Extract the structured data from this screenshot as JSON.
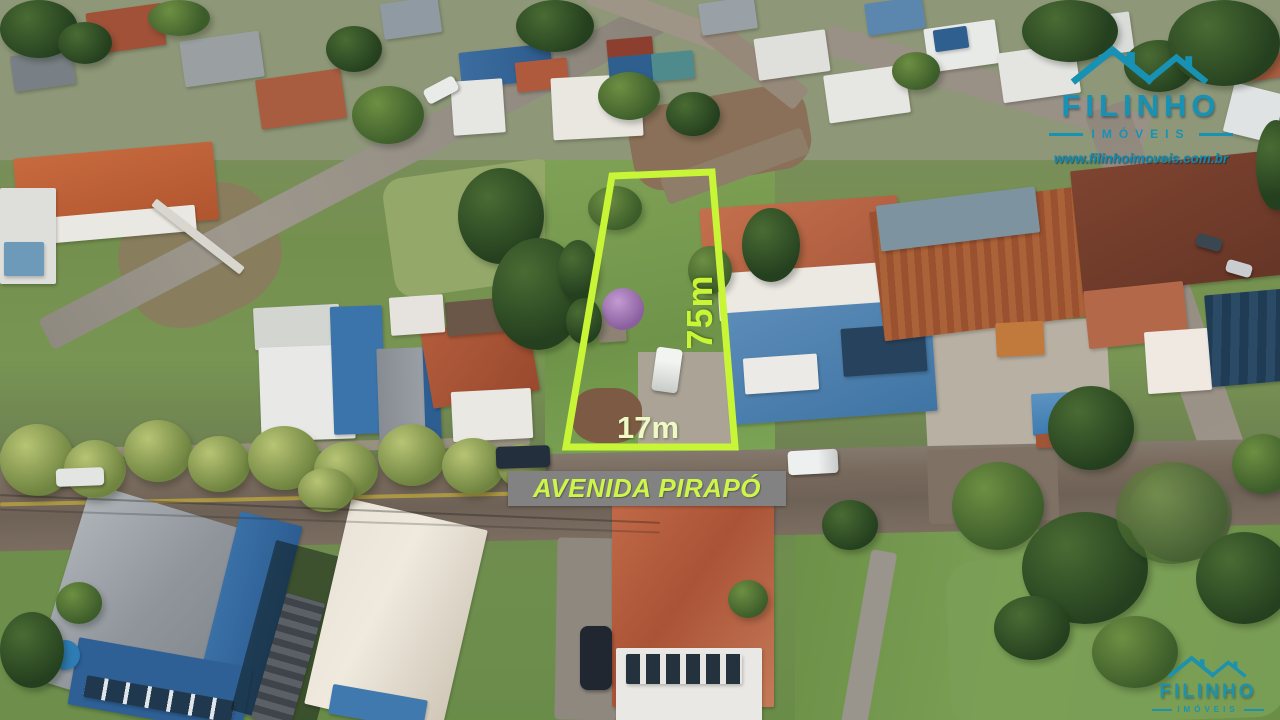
{
  "brand": {
    "name": "FILINHO",
    "tagline": "IMÓVEIS",
    "website": "www.filinhoimoveis.com.br",
    "color": "#1792b4"
  },
  "lot": {
    "depth_label": "75m",
    "width_label": "17m",
    "outline_color": "#c8f536"
  },
  "street": {
    "name": "AVENIDA PIRAPÓ",
    "banner_color": "#828282",
    "label_color": "#cdf649"
  }
}
